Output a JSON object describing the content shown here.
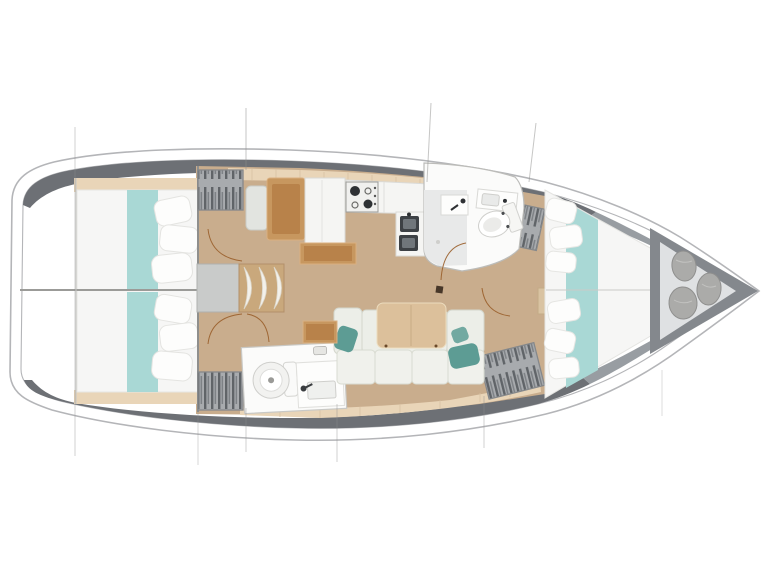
{
  "diagram": {
    "title": "Sailing yacht interior layout — top-view floor plan",
    "orientation_bow": "right",
    "orientation_stern": "left"
  },
  "colors": {
    "background": "#ffffff",
    "hull_line": "#b4b5b8",
    "deck": "#6d7075",
    "deck_bow": "#989da2",
    "deck_dark": "#4d5156",
    "floor": "#c9ad8d",
    "trim": "#e9d5b8",
    "trim_line": "#d8c1a2",
    "mattress": "#f6f6f5",
    "teal_light": "#a9d8d5",
    "teal_dark": "#5d9c94",
    "cushion": "#eceee8",
    "cushion_seat": "#f0f1ec",
    "table_wood": "#dcc09b",
    "chart_wood": "#b8824a",
    "chart_frame": "#c7975f",
    "counter": "#f5f5f3",
    "sink_dark": "#3d4145",
    "sink_inner": "#70767b",
    "steps_wood": "#c9a87c",
    "engine_box": "#c9cbca",
    "wardrobe_base": "#a8abae",
    "wardrobe_stripe": "#606468",
    "wardrobe_stripe2": "#7d8185",
    "door_arc": "#9a5f2b",
    "bag": "#ababa9",
    "forepeak_floor": "#dfe1e3",
    "forepeak_wall": "#84888d",
    "head_floor": "#e8e9e9",
    "white": "#ffffff"
  },
  "areas": {
    "aft_cabin_top": {
      "name": "Aft cabin (starboard)",
      "features": [
        "double berth",
        "teal runner",
        "pillows",
        "hanging wardrobe"
      ]
    },
    "aft_cabin_bottom": {
      "name": "Aft cabin (port)",
      "features": [
        "double berth",
        "teal runner",
        "pillows",
        "hanging wardrobe"
      ]
    },
    "companionway": {
      "name": "Companionway",
      "features": [
        "engine box",
        "three steps"
      ]
    },
    "nav_station": {
      "name": "Nav station",
      "features": [
        "seat",
        "chart table"
      ]
    },
    "galley": {
      "name": "Galley",
      "features": [
        "refrigerator",
        "two-burner stove",
        "double sink",
        "counter"
      ]
    },
    "forward_head": {
      "name": "Forward head",
      "features": [
        "shower",
        "wash basin",
        "toilet"
      ]
    },
    "aft_head": {
      "name": "Aft head",
      "features": [
        "toilet",
        "wash basin"
      ]
    },
    "saloon": {
      "name": "Saloon",
      "features": [
        "L-settee",
        "teal cushions",
        "dining table",
        "side table"
      ]
    },
    "forward_cabin": {
      "name": "Forward cabin",
      "features": [
        "V-berth",
        "teal runner",
        "pillows",
        "wardrobe"
      ]
    },
    "bow_locker": {
      "name": "Bow sail locker",
      "features": [
        "three sail bags"
      ]
    }
  }
}
